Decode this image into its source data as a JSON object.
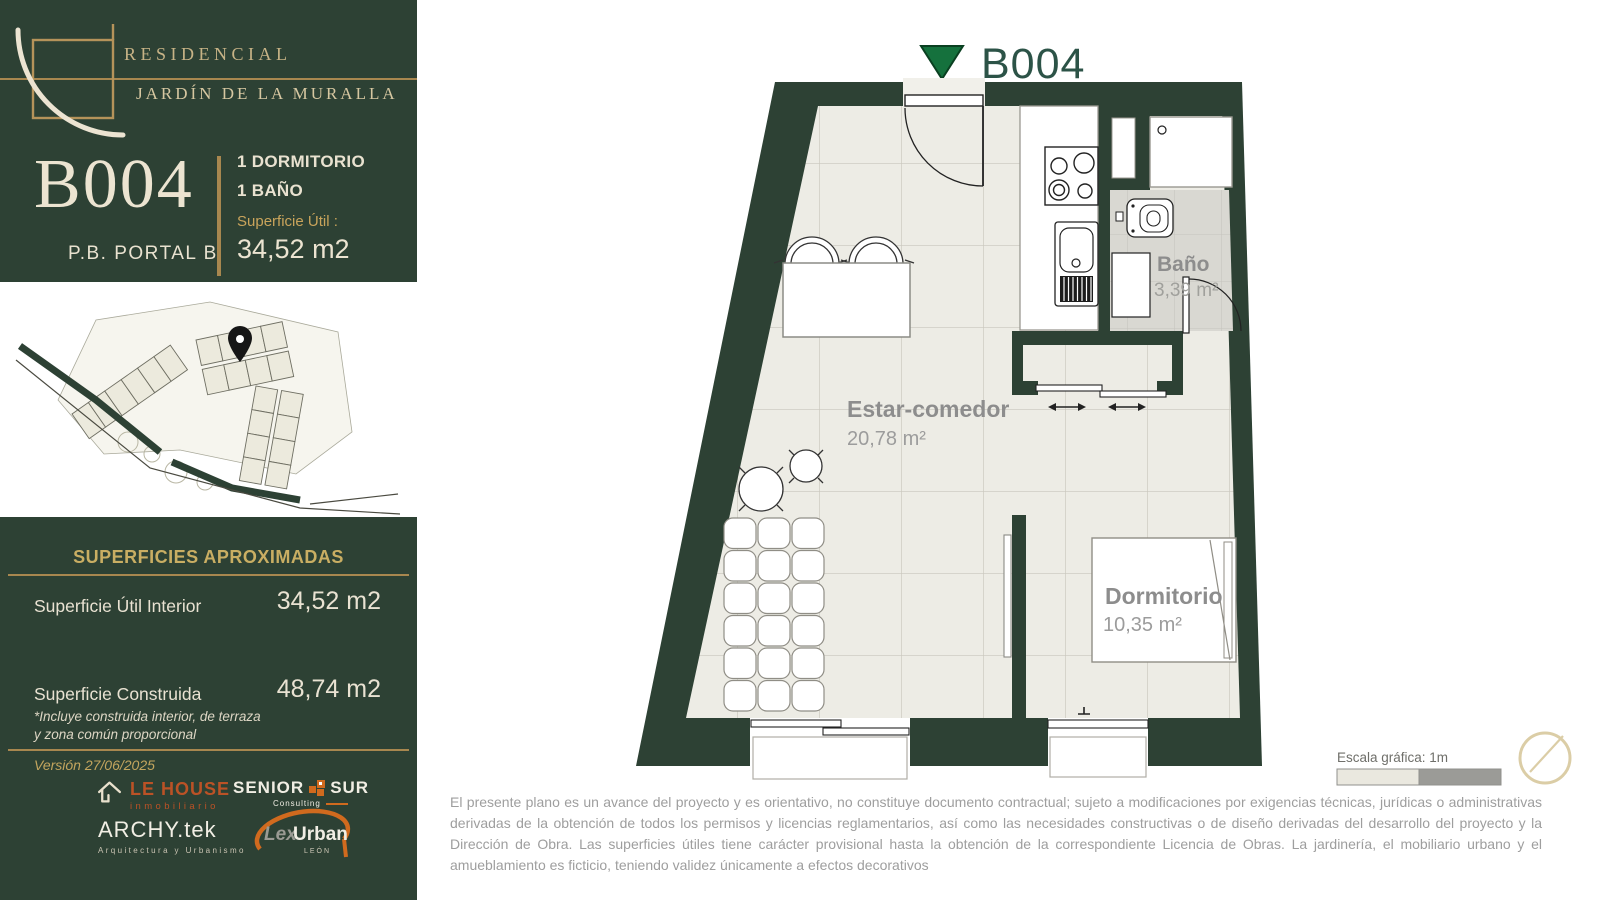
{
  "brand": {
    "line1": "RESIDENCIAL",
    "line2": "JARDÍN DE LA MURALLA"
  },
  "unit": {
    "code": "B004",
    "location": "P.B. PORTAL B",
    "feature1": "1 DORMITORIO",
    "feature2": "1 BAÑO",
    "area_label": "Superficie  Útil :",
    "area_value": "34,52 m2"
  },
  "surfaces": {
    "heading": "SUPERFICIES APROXIMADAS",
    "rows": [
      {
        "label": "Superficie  Útil Interior",
        "value": "34,52 m2"
      },
      {
        "label": "Superficie  Construida",
        "value": "48,74 m2"
      }
    ],
    "note1": "*Incluye construida interior, de terraza",
    "note2": "y zona común proporcional",
    "version": "Versión 27/06/2025"
  },
  "partners": {
    "lehouse": {
      "name": "LE HOUSE",
      "tagline": "inmobiliario"
    },
    "seniorsur": {
      "word1": "SENIOR",
      "word2": "SUR",
      "tagline": "Consulting"
    },
    "archytek": {
      "name": "ARCHY.tek",
      "tagline": "Arquitectura y Urbanismo"
    },
    "lexurban": {
      "word1": "Lex",
      "word2": "Urban",
      "tagline": "LEÓN"
    }
  },
  "plan": {
    "title": "B004",
    "rooms": [
      {
        "name": "Estar-comedor",
        "area": "20,78 m²"
      },
      {
        "name": "Baño",
        "area": "3,39 m²"
      },
      {
        "name": "Dormitorio",
        "area": "10,35 m²"
      }
    ],
    "scale_label": "Escala gráfica:  1m"
  },
  "disclaimer": "El presente plano es un avance del proyecto y es orientativo, no constituye documento contractual; sujeto a modificaciones por exigencias técnicas, jurídicas o administrativas derivadas de la obtención de todos los permisos y licencias reglamentarios, así como las necesidades constructivas o de diseño derivadas del desarrollo del proyecto y la Dirección de Obra. Las superficies útiles tiene carácter provisional hasta la obtención de la correspondiente Licencia de Obras. La jardinería, el mobiliario urbano y el amueblamiento es ficticio, teniendo validez únicamente a efectos decorativos",
  "colors": {
    "sidebar_green": "#2d4134",
    "gold": "#a8874f",
    "cream": "#ece4d1",
    "logo_orange": "#c65b27",
    "room_label_gray": "#8f8f8f",
    "floor_beige": "#edece5",
    "bath_gray": "#d9d8d2",
    "marker_green": "#15713d"
  }
}
